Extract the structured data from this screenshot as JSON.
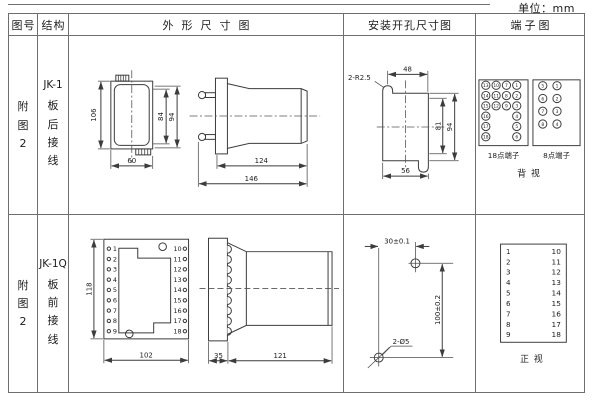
{
  "unit": "单位：mm",
  "header": {
    "figure": "图号",
    "structure": "结构",
    "outline": "外形尺寸图",
    "mounting": "安装开孔尺寸图",
    "terminal": "端子图"
  },
  "row1": {
    "figure": [
      "附",
      "图",
      "2"
    ],
    "structure": {
      "model": "JK-1",
      "chars": [
        "板",
        "后",
        "接",
        "线"
      ]
    },
    "outline": {
      "front": {
        "height": "106",
        "inner_height": "84",
        "outer_height": "94",
        "width": "60"
      },
      "side": {
        "body_length": "124",
        "total_length": "146"
      }
    },
    "mounting": {
      "radius_label": "2-R2.5",
      "top_width": "48",
      "inner_height": "81",
      "outer_height": "94",
      "bottom_width": "56"
    },
    "terminal": {
      "t18": [
        "13",
        "10",
        "7",
        "1",
        "14",
        "11",
        "8",
        "2",
        "15",
        "12",
        "9",
        "3",
        "16",
        "4",
        "17",
        "5",
        "18",
        "6"
      ],
      "t18_label": "18点端子",
      "t8": [
        "5",
        "1",
        "6",
        "2",
        "7",
        "3",
        "8",
        "4"
      ],
      "t8_label": "8点端子",
      "view": "背视"
    }
  },
  "row2": {
    "figure": [
      "附",
      "图",
      "2"
    ],
    "structure": {
      "model": "JK-1Q",
      "chars": [
        "板",
        "前",
        "接",
        "线"
      ]
    },
    "outline": {
      "height": "118",
      "width": "102",
      "side": {
        "flange": "35",
        "body": "121"
      }
    },
    "terminals": {
      "left": [
        "1",
        "2",
        "3",
        "4",
        "5",
        "6",
        "7",
        "8",
        "9"
      ],
      "right": [
        "10",
        "11",
        "12",
        "13",
        "14",
        "15",
        "16",
        "17",
        "18"
      ]
    },
    "mounting": {
      "horizontal": "30±0.1",
      "vertical": "100±0.2",
      "holes_label": "2-Ø5"
    },
    "terminal_view": "正视"
  }
}
